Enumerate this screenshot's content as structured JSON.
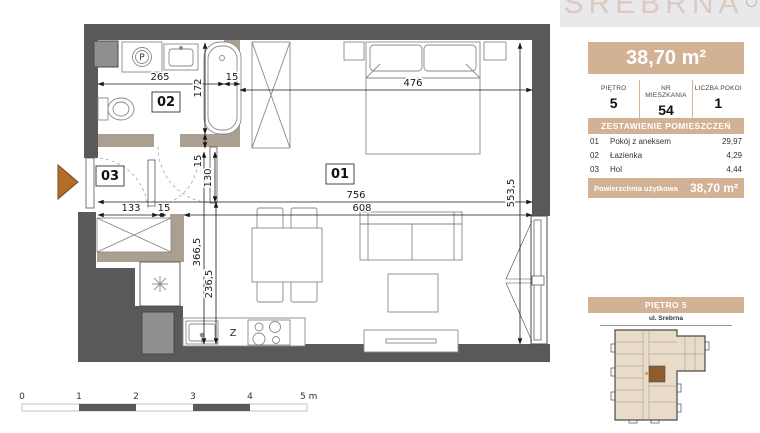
{
  "plan": {
    "rooms": [
      {
        "label": "01",
        "name": "Pokój z aneksem"
      },
      {
        "label": "02",
        "name": "Łazienka"
      },
      {
        "label": "03",
        "name": "Hol"
      }
    ],
    "dimensions": {
      "w265": "265",
      "w15_bath": "15",
      "w476": "476",
      "h172": "172",
      "h15_tub": "15",
      "h130": "130",
      "h553": "553,5",
      "w756": "756",
      "w133": "133",
      "w15_hall": "15",
      "w608": "608",
      "h366": "366,5",
      "h236": "236,5"
    },
    "labels": {
      "washer": "P",
      "dishwasher": "Z"
    },
    "scale_bar": {
      "ticks": [
        "0",
        "1",
        "2",
        "3",
        "4"
      ],
      "end": "5 m"
    }
  },
  "sidebar": {
    "logo_text": "SREBRNA",
    "area_banner": "38,70 m²",
    "info_columns": [
      {
        "label": "PIĘTRO",
        "value": "5"
      },
      {
        "label": "NR MIESZKANIA",
        "value": "54"
      },
      {
        "label": "LICZBA POKOI",
        "value": "1"
      }
    ],
    "rooms_table": {
      "title": "ZESTAWIENIE POMIESZCZEŃ",
      "rows": [
        {
          "no": "01",
          "name": "Pokój z aneksem",
          "area": "29,97"
        },
        {
          "no": "02",
          "name": "Łazienka",
          "area": "4,29"
        },
        {
          "no": "03",
          "name": "Hol",
          "area": "4,44"
        }
      ],
      "footer_label": "Powierzchnia użytkowa",
      "footer_value": "38,70 m²"
    },
    "floor_plan_section": {
      "title": "PIĘTRO 5",
      "street_label": "ul. Srebrna"
    }
  },
  "colors": {
    "accent_tan": "#d3b195",
    "wall_dark": "#595959",
    "wall_interior": "#ab9f91",
    "entrance_triangle": "#b06e2a",
    "building_fill": "#e8dcc9",
    "unit_highlight": "#8f5c2e"
  }
}
